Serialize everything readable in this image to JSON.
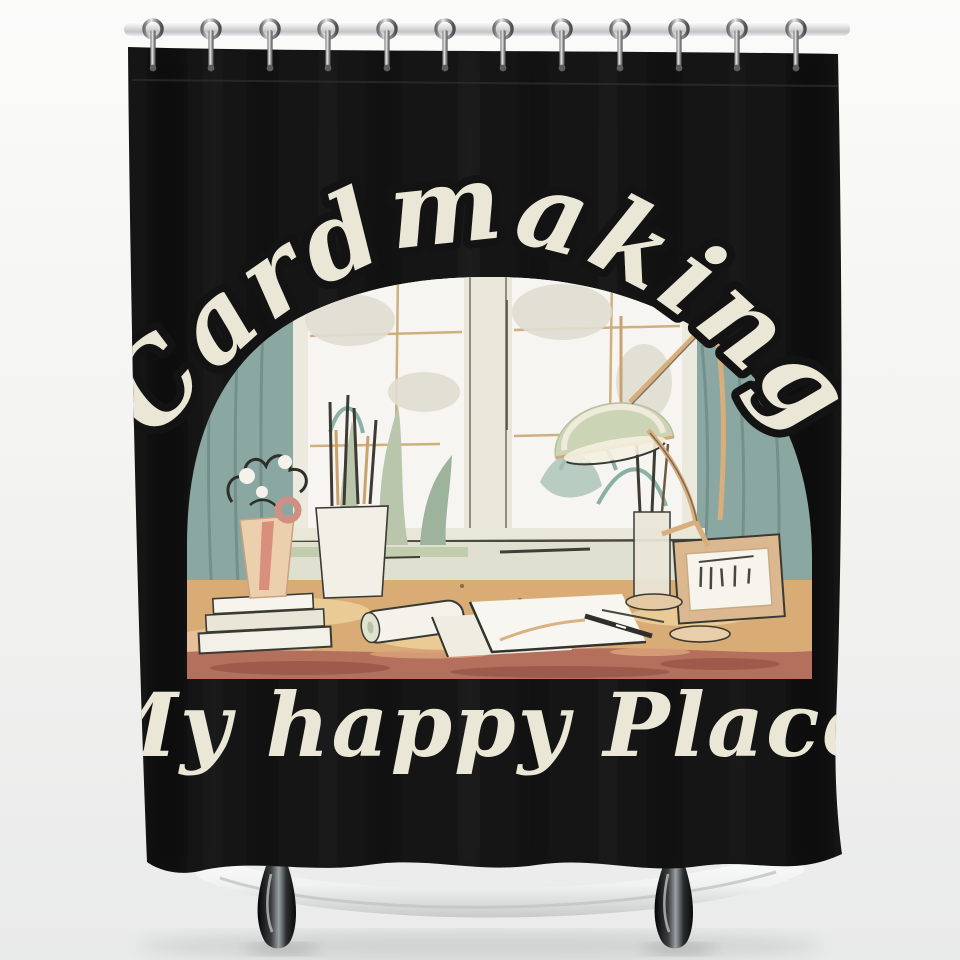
{
  "meta": {
    "scene": "Product photo of a printed shower curtain hanging from a chrome rod over a white clawfoot bathtub"
  },
  "curtain_print": {
    "title": "Cardmaking",
    "subtitle": "My happy Place",
    "illustration": "cozy craft desk in front of an arched window with hanging lamp, plants, flowers, books, pencil cup, papers and picture frame",
    "text_color": "#ebe7d6",
    "curtain_color": "#151515"
  },
  "illustration_colors": {
    "wall_teal": "#8ba7a1",
    "window_white": "#f6f5f1",
    "frame_cream": "#eceadf",
    "desk_tan": "#d8ac74",
    "desk_front_terracotta": "#b5705d",
    "lamp_sage": "#ccd4b6",
    "accent_pink": "#cf8f83",
    "outline_dark": "#33332e"
  },
  "hardware": {
    "rod_name": "chrome shower rod",
    "hook_name": "chrome shower hook",
    "hook_count": 12,
    "tub_name": "white clawfoot bathtub",
    "tub_feet_count": 2
  },
  "background_color": "#f2f2f0"
}
